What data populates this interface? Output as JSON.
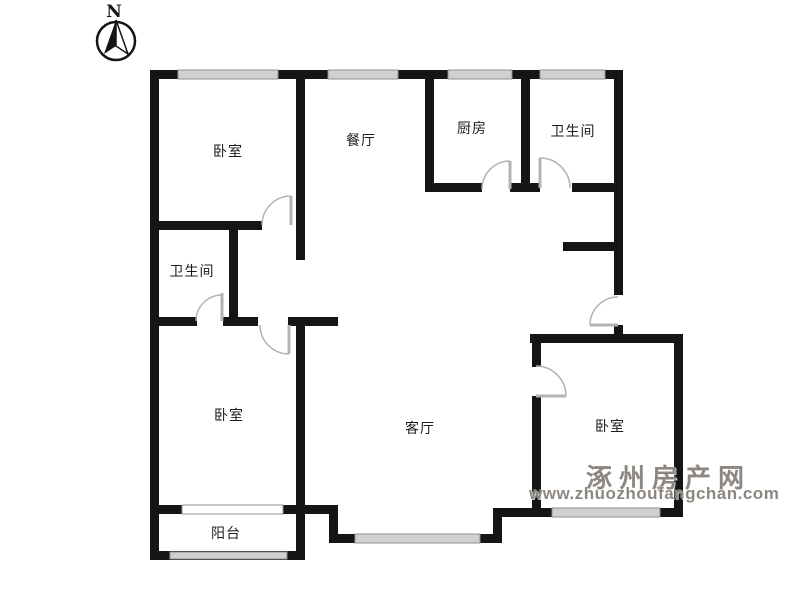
{
  "compass": {
    "label": "N"
  },
  "rooms": [
    {
      "id": "bedroom-northwest",
      "label": "卧室"
    },
    {
      "id": "dining-room",
      "label": "餐厅"
    },
    {
      "id": "kitchen",
      "label": "厨房"
    },
    {
      "id": "bathroom-northeast",
      "label": "卫生间"
    },
    {
      "id": "bathroom-west",
      "label": "卫生间"
    },
    {
      "id": "bedroom-southwest",
      "label": "卧室"
    },
    {
      "id": "living-room",
      "label": "客厅"
    },
    {
      "id": "bedroom-southeast",
      "label": "卧室"
    },
    {
      "id": "balcony",
      "label": "阳台"
    }
  ],
  "watermark": {
    "site_name": "涿州房产网",
    "site_url": "www.zhuozhoufangchan.com"
  },
  "colors": {
    "wall": "#151515",
    "window_fill": "#d0d0d0",
    "window_edge": "#8f8f8f",
    "interior_window_fill": "#ffffff",
    "door": "#b3b3b3",
    "watermark": "#8d8781",
    "background": "#ffffff"
  }
}
